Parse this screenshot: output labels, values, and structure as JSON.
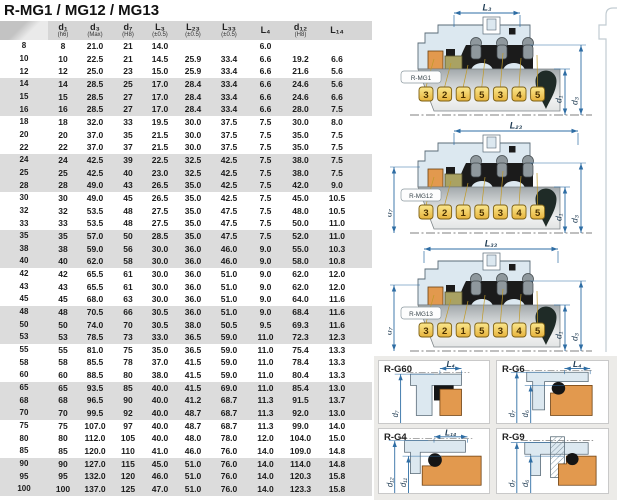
{
  "title": "R-MG1 / MG12 / MG13",
  "table": {
    "headers": [
      {
        "label": "",
        "sub": ""
      },
      {
        "label": "d₁",
        "sub": "(h6)"
      },
      {
        "label": "d₃",
        "sub": "(Max)"
      },
      {
        "label": "d₇",
        "sub": "(H8)"
      },
      {
        "label": "L₃",
        "sub": "(±0.5)"
      },
      {
        "label": "L₂₃",
        "sub": "(±0.5)"
      },
      {
        "label": "L₃₃",
        "sub": "(±0.5)"
      },
      {
        "label": "L₄",
        "sub": ""
      },
      {
        "label": "d₁₂",
        "sub": "(H8)"
      },
      {
        "label": "L₁₄",
        "sub": ""
      }
    ],
    "rows": [
      [
        "8",
        "8",
        "21.0",
        "21",
        "14.0",
        "",
        "",
        "6.0",
        "",
        ""
      ],
      [
        "10",
        "10",
        "22.5",
        "21",
        "14.5",
        "25.9",
        "33.4",
        "6.6",
        "19.2",
        "6.6"
      ],
      [
        "12",
        "12",
        "25.0",
        "23",
        "15.0",
        "25.9",
        "33.4",
        "6.6",
        "21.6",
        "5.6"
      ],
      [
        "14",
        "14",
        "28.5",
        "25",
        "17.0",
        "28.4",
        "33.4",
        "6.6",
        "24.6",
        "5.6"
      ],
      [
        "15",
        "15",
        "28.5",
        "27",
        "17.0",
        "28.4",
        "33.4",
        "6.6",
        "24.6",
        "6.6"
      ],
      [
        "16",
        "16",
        "28.5",
        "27",
        "17.0",
        "28.4",
        "33.4",
        "6.6",
        "28.0",
        "7.5"
      ],
      [
        "18",
        "18",
        "32.0",
        "33",
        "19.5",
        "30.0",
        "37.5",
        "7.5",
        "30.0",
        "8.0"
      ],
      [
        "20",
        "20",
        "37.0",
        "35",
        "21.5",
        "30.0",
        "37.5",
        "7.5",
        "35.0",
        "7.5"
      ],
      [
        "22",
        "22",
        "37.0",
        "37",
        "21.5",
        "30.0",
        "37.5",
        "7.5",
        "35.0",
        "7.5"
      ],
      [
        "24",
        "24",
        "42.5",
        "39",
        "22.5",
        "32.5",
        "42.5",
        "7.5",
        "38.0",
        "7.5"
      ],
      [
        "25",
        "25",
        "42.5",
        "40",
        "23.0",
        "32.5",
        "42.5",
        "7.5",
        "38.0",
        "7.5"
      ],
      [
        "28",
        "28",
        "49.0",
        "43",
        "26.5",
        "35.0",
        "42.5",
        "7.5",
        "42.0",
        "9.0"
      ],
      [
        "30",
        "30",
        "49.0",
        "45",
        "26.5",
        "35.0",
        "42.5",
        "7.5",
        "45.0",
        "10.5"
      ],
      [
        "32",
        "32",
        "53.5",
        "48",
        "27.5",
        "35.0",
        "47.5",
        "7.5",
        "48.0",
        "10.5"
      ],
      [
        "33",
        "33",
        "53.5",
        "48",
        "27.5",
        "35.0",
        "47.5",
        "7.5",
        "50.0",
        "11.0"
      ],
      [
        "35",
        "35",
        "57.0",
        "50",
        "28.5",
        "35.0",
        "47.5",
        "7.5",
        "52.0",
        "11.0"
      ],
      [
        "38",
        "38",
        "59.0",
        "56",
        "30.0",
        "36.0",
        "46.0",
        "9.0",
        "55.0",
        "10.3"
      ],
      [
        "40",
        "40",
        "62.0",
        "58",
        "30.0",
        "36.0",
        "46.0",
        "9.0",
        "58.0",
        "10.8"
      ],
      [
        "42",
        "42",
        "65.5",
        "61",
        "30.0",
        "36.0",
        "51.0",
        "9.0",
        "62.0",
        "12.0"
      ],
      [
        "43",
        "43",
        "65.5",
        "61",
        "30.0",
        "36.0",
        "51.0",
        "9.0",
        "62.0",
        "12.0"
      ],
      [
        "45",
        "45",
        "68.0",
        "63",
        "30.0",
        "36.0",
        "51.0",
        "9.0",
        "64.0",
        "11.6"
      ],
      [
        "48",
        "48",
        "70.5",
        "66",
        "30.5",
        "36.0",
        "51.0",
        "9.0",
        "68.4",
        "11.6"
      ],
      [
        "50",
        "50",
        "74.0",
        "70",
        "30.5",
        "38.0",
        "50.5",
        "9.5",
        "69.3",
        "11.6"
      ],
      [
        "53",
        "53",
        "78.5",
        "73",
        "33.0",
        "36.5",
        "59.0",
        "11.0",
        "72.3",
        "12.3"
      ],
      [
        "55",
        "55",
        "81.0",
        "75",
        "35.0",
        "36.5",
        "59.0",
        "11.0",
        "75.4",
        "13.3"
      ],
      [
        "58",
        "58",
        "85.5",
        "78",
        "37.0",
        "41.5",
        "59.0",
        "11.0",
        "78.4",
        "13.3"
      ],
      [
        "60",
        "60",
        "88.5",
        "80",
        "38.0",
        "41.5",
        "59.0",
        "11.0",
        "80.4",
        "13.3"
      ],
      [
        "65",
        "65",
        "93.5",
        "85",
        "40.0",
        "41.5",
        "69.0",
        "11.0",
        "85.4",
        "13.0"
      ],
      [
        "68",
        "68",
        "96.5",
        "90",
        "40.0",
        "41.2",
        "68.7",
        "11.3",
        "91.5",
        "13.7"
      ],
      [
        "70",
        "70",
        "99.5",
        "92",
        "40.0",
        "48.7",
        "68.7",
        "11.3",
        "92.0",
        "13.0"
      ],
      [
        "75",
        "75",
        "107.0",
        "97",
        "40.0",
        "48.7",
        "68.7",
        "11.3",
        "99.0",
        "14.0"
      ],
      [
        "80",
        "80",
        "112.0",
        "105",
        "40.0",
        "48.0",
        "78.0",
        "12.0",
        "104.0",
        "15.0"
      ],
      [
        "85",
        "85",
        "120.0",
        "110",
        "41.0",
        "46.0",
        "76.0",
        "14.0",
        "109.0",
        "14.8"
      ],
      [
        "90",
        "90",
        "127.0",
        "115",
        "45.0",
        "51.0",
        "76.0",
        "14.0",
        "114.0",
        "14.8"
      ],
      [
        "95",
        "95",
        "132.0",
        "120",
        "46.0",
        "51.0",
        "76.0",
        "14.0",
        "120.3",
        "15.8"
      ],
      [
        "100",
        "100",
        "137.0",
        "125",
        "47.0",
        "51.0",
        "76.0",
        "14.0",
        "123.3",
        "15.8"
      ]
    ]
  },
  "diagrams": [
    {
      "name": "R-MG1",
      "top_dim": "L₃",
      "left_dim": "",
      "dim_inner": "d₁",
      "dim_outer": "d₃",
      "callouts": [
        "3",
        "2",
        "1",
        "5",
        "3",
        "4",
        "5"
      ]
    },
    {
      "name": "R-MG12",
      "top_dim": "L₂₃",
      "left_dim": "d₇",
      "dim_inner": "d₁",
      "dim_outer": "d₃",
      "callouts": [
        "3",
        "2",
        "1",
        "5",
        "3",
        "4",
        "5"
      ]
    },
    {
      "name": "R-MG13",
      "top_dim": "L₃₃",
      "left_dim": "d₇",
      "dim_inner": "d₁",
      "dim_outer": "d₃",
      "callouts": [
        "3",
        "2",
        "1",
        "5",
        "3",
        "4",
        "5"
      ]
    }
  ],
  "seat_panels": [
    {
      "name": "R-G60",
      "variant": "g60",
      "top_dim": "L₄",
      "left_dims": [
        "d₇"
      ]
    },
    {
      "name": "R-G6",
      "variant": "g6",
      "top_dim": "L₄",
      "left_dims": [
        "d₇",
        "d₆"
      ]
    },
    {
      "name": "R-G4",
      "variant": "g4",
      "top_dim": "L₁₄",
      "left_dims": [
        "d₁₂",
        "d₁₁"
      ]
    },
    {
      "name": "R-G9",
      "variant": "g9",
      "top_dim": "",
      "left_dims": [
        "d₇",
        "d₆"
      ]
    }
  ],
  "colors": {
    "dimension": "#2e6da4",
    "dim_text": "#1d3a52",
    "housing": "#dce8f0",
    "seat_orange": "#e2994e",
    "seal_olive": "#a9a263",
    "elastomer": "#1b1b1b",
    "oring_dark": "#1f2b27",
    "callout_gold": "#f0c84a",
    "leader": "#c09a2a",
    "band_gray": "#dcdcdc",
    "header_gray": "#d6d6d6"
  }
}
